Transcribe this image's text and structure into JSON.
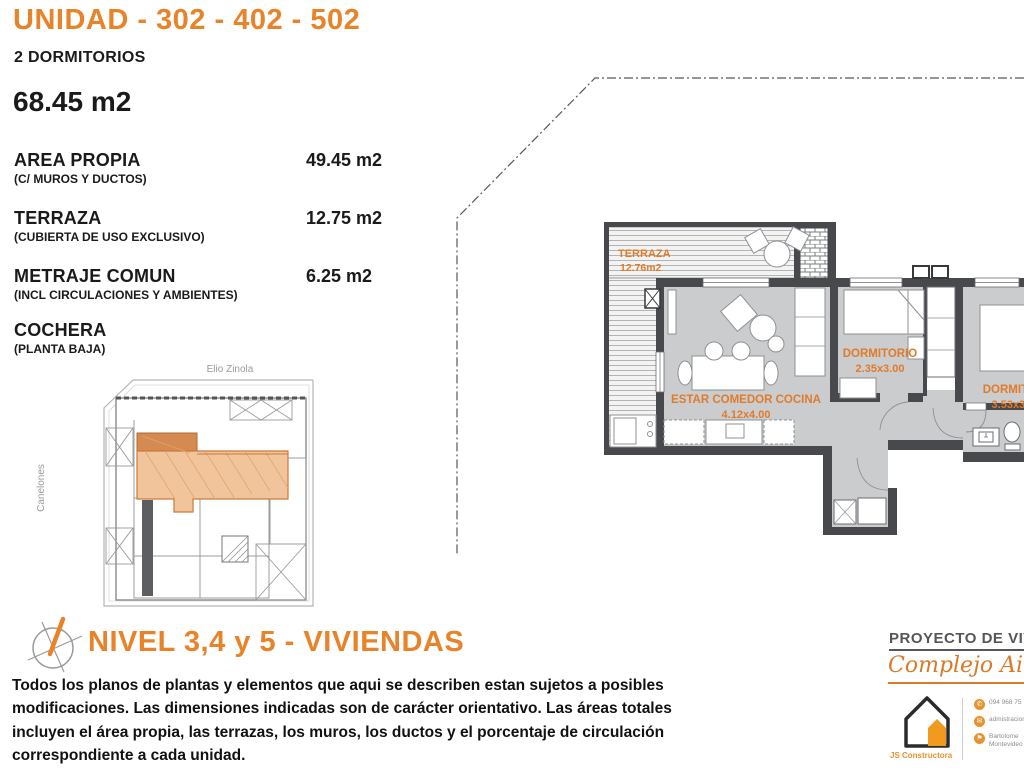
{
  "header": {
    "title": "UNIDAD - 302 - 402 - 502",
    "subtitle": "2 DORMITORIOS",
    "total_area": "68.45 m2"
  },
  "areas": [
    {
      "label": "AREA PROPIA",
      "note": "(C/ MUROS Y DUCTOS)",
      "value": "49.45 m2"
    },
    {
      "label": "TERRAZA",
      "note": "(CUBIERTA DE USO EXCLUSIVO)",
      "value": "12.75 m2"
    },
    {
      "label": "METRAJE COMUN",
      "note": "(INCL CIRCULACIONES Y AMBIENTES)",
      "value": "6.25 m2"
    },
    {
      "label": "COCHERA",
      "note": "(PLANTA BAJA)",
      "value": ""
    }
  ],
  "site_plan": {
    "street_top": "Elio Zinola",
    "street_left": "Canelones"
  },
  "floor_plan": {
    "terraza_label": "TERRAZA",
    "terraza_area": "12.76m2",
    "living_label": "ESTAR COMEDOR COCINA",
    "living_dims": "4.12x4.00",
    "bedroom1_label": "DORMITORIO",
    "bedroom1_dims": "2.35x3.00",
    "bedroom2_label": "DORMITORIO",
    "bedroom2_dims": "3.53x3.00"
  },
  "level": {
    "title": "NIVEL 3,4 y 5 - VIVIENDAS"
  },
  "disclaimer": "Todos los planos de plantas y elementos que aqui se describen estan sujetos a posibles modificaciones.  Las dimensiones indicadas son de carácter orientativo. Las áreas totales incluyen el área propia, las terrazas, los muros, los ductos y el porcentaje de circulación correspondiente a cada unidad.",
  "footer": {
    "project_label": "PROYECTO DE VIVIENDAS",
    "project_name": "Complejo Aires de Cordón",
    "builder": "JS Constructora",
    "contacts": [
      {
        "name": "phone",
        "glyph": "✆",
        "line1": "094 968 75"
      },
      {
        "name": "email",
        "glyph": "✉",
        "line1": "admistracion"
      },
      {
        "name": "location",
        "glyph": "⚑",
        "line1": "Bartolome",
        "line2": "Montevideo"
      }
    ]
  },
  "colors": {
    "accent_orange": "#e8832a",
    "wall_dark": "#47494c",
    "floor_gray": "#caccce",
    "unit_highlight": "#f2c49b",
    "unit_highlight_dark": "#d58a52"
  }
}
